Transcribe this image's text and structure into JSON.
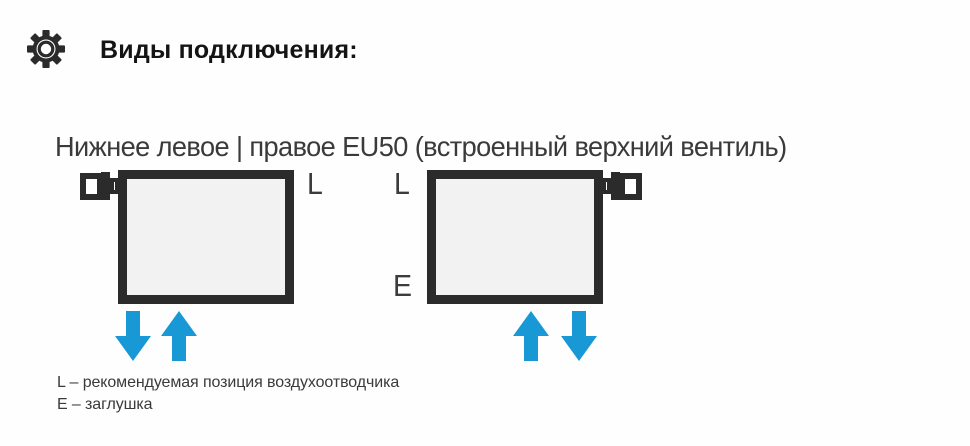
{
  "header": {
    "icon": "gear-icon",
    "title": "Виды подключения:"
  },
  "subtitle": "Нижнее левое | правое EU50 (встроенный верхний вентиль)",
  "colors": {
    "line_dark": "#2b2b2b",
    "radiator_fill": "#f2f2f2",
    "arrow_blue": "#1899d6",
    "text_dark": "#3a3a3a",
    "background": "#fefefe"
  },
  "diagrams": [
    {
      "name": "bottom-left-connection",
      "valve_side": "top-left",
      "label_l": "L",
      "label_l_position": "top-right",
      "arrows": [
        "down",
        "up"
      ]
    },
    {
      "name": "bottom-right-connection",
      "valve_side": "top-right",
      "label_l": "L",
      "label_l_position": "top-left",
      "label_e": "E",
      "label_e_position": "bottom-left",
      "arrows": [
        "up",
        "down"
      ]
    }
  ],
  "legend": {
    "line1": "L – рекомендуемая позиция воздухоотводчика",
    "line2": "E – заглушка"
  }
}
